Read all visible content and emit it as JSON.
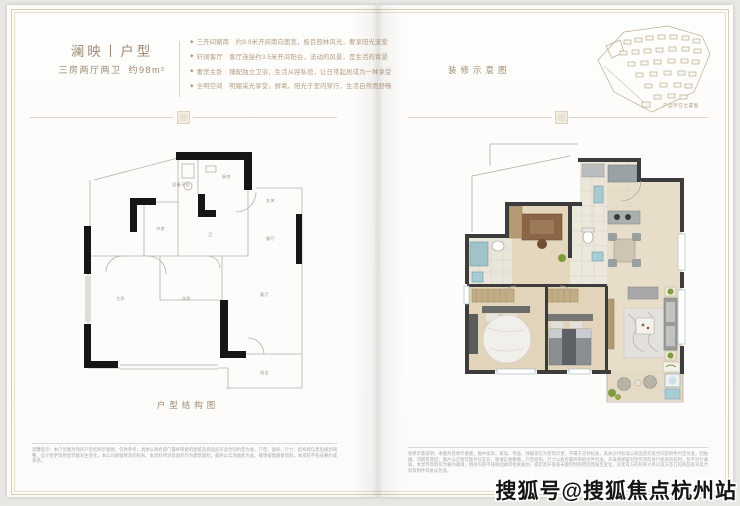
{
  "colors": {
    "accent_tan": "#a18a70",
    "feature_tan": "#b59c80",
    "frame_line": "#d9cdb6",
    "wall_black": "#161616",
    "wall_dark": "#3c3c3c",
    "floor_beige": "#e7ddc9",
    "floor_wood": "#e2d4ba",
    "plant_green": "#7f9b3f",
    "water_blue": "#a8ccd4",
    "watermark_black": "#141414"
  },
  "left_page": {
    "title": "澜映丨户型",
    "subtitle_main": "三房两厅两卫",
    "subtitle_area": "约98m²",
    "features": [
      {
        "bullet": "◆",
        "text": "三开间朝南　约9.9米开间南向面宽，极目园林风光，奢享阳光宠爱"
      },
      {
        "bullet": "◆",
        "text": "轩阔客厅　客厅连接约3.5米开间阳台，流动的风景，是生活的背景"
      },
      {
        "bullet": "◆",
        "text": "奢宽主卧　臻配独立卫浴，生活从容私密，让日常起居成为一种享受"
      },
      {
        "bullet": "◆",
        "text": "全明空间　明媚采光享受，鲜氧、阳光于室内穿行，生活自然而舒畅"
      }
    ],
    "plan_caption": "户型结构图",
    "room_labels": [
      "设备平台",
      "厨房",
      "书房",
      "卫",
      "玄关",
      "餐厅",
      "主卧",
      "次卧",
      "客厅",
      "阳台"
    ],
    "disclaimer": "温馨提示：本户型图为项目户型结构示意图，仅供参考，具体以政府部门最终审批的图纸及商品房买卖合同约定为准。户型、面积、尺寸、结构等信息因规划调整、设计变更等原因可能发生变化，本公司保留修改的权利。本资料所涉及面积均为建筑面积，最终以实测面积为准。敬请留意最新资料，本资料不构成要约或承诺。"
  },
  "right_page": {
    "label": "装修示意图",
    "sitemap_caption": "户型所在位置图",
    "disclaimer": "装修示意说明：本图为装修示意图，图中家具、家电、饰品、绿植等仅为装饰示意，不属于交付标准，具体交付标准以商品房买卖合同及附件约定为准。因拍摄、印刷等原因，图片与实物可能存在差异，敬请实地察看。户型结构、尺寸以政府最终审批文件为准，开发商保留对宣传资料进行修改的权利，恕不另行通知。本宣传资料仅为要约邀请，相关内容不排除因政府相关规划、规定及开发商未能控制的原因而发生变化。买卖双方的权利义务以双方签订的商品房买卖合同及附件等协议为准。"
  },
  "watermark": "搜狐号@搜狐焦点杭州站"
}
